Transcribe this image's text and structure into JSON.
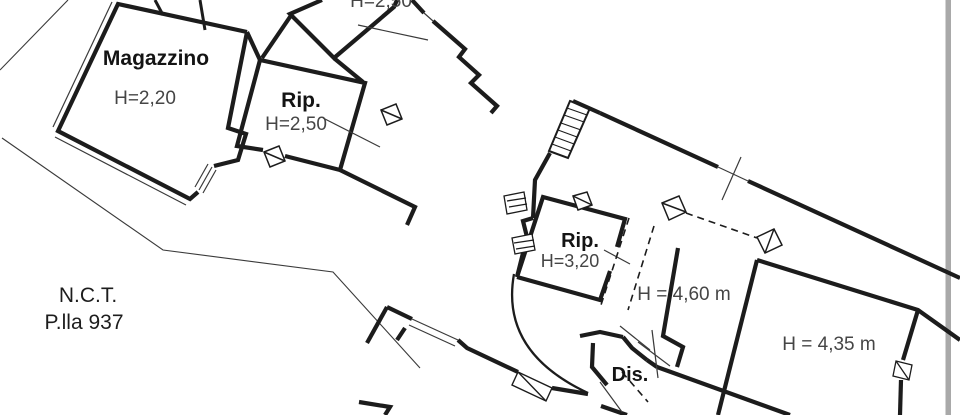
{
  "drawing": {
    "kind": "cadastral floor plan",
    "parcel": {
      "registry": "N.C.T.",
      "number": "P.lla 937"
    },
    "rooms": [
      {
        "name": "Magazzino",
        "height": "H=2,20"
      },
      {
        "name": "Rip.",
        "height": "H=2,50"
      },
      {
        "name": "",
        "height": "H=2,50"
      },
      {
        "name": "Rip.",
        "height": "H=3,20"
      },
      {
        "name": "",
        "height": "H = 4,60 m"
      },
      {
        "name": "",
        "height": "H = 4,35 m"
      },
      {
        "name": "Dis.",
        "height": ""
      }
    ],
    "colors": {
      "wall": "#1c1c1c",
      "thin_line": "#3a3a3a",
      "height_text": "#454545",
      "room_text": "#141414",
      "page_edge_bar": "#a9a9a9",
      "background": "#ffffff"
    }
  }
}
